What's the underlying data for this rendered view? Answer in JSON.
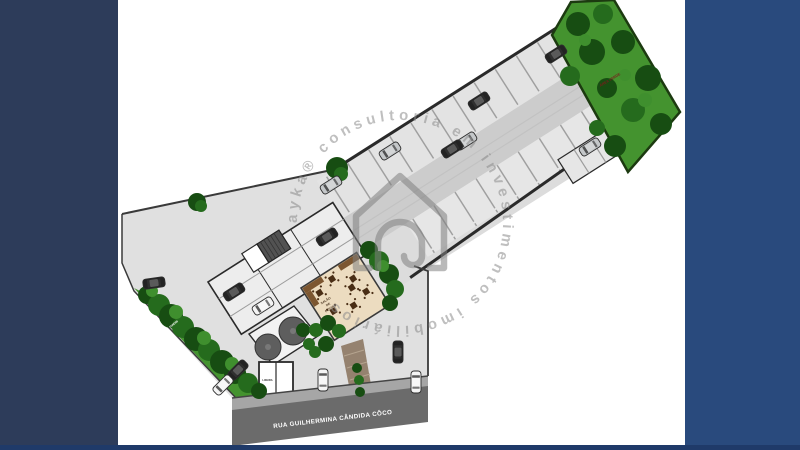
{
  "frame": {
    "background": "#ffffff",
    "left_bar_color": "#2d3c5a",
    "right_bar_color": "#294a7d",
    "bottom_line_color": "#1f3a69"
  },
  "watermark": {
    "circle_text": "ayka®  consultoria em investimentos  imobiliários",
    "color": "#8c8c8c",
    "house_icon": "house-outline-icon"
  },
  "site_plan": {
    "labels": {
      "green_area": "ÁREA VERDE",
      "party_room_line1": "SALÃO",
      "party_room_line2": "DE",
      "party_room_line3": "FESTAS",
      "trash_room": "LIXEIRA",
      "garden": "JARDIM",
      "street": "RUA GUILHERMINA CÂNDIDA CÔCO"
    },
    "colors": {
      "pavement": "#e0e0e0",
      "stall": "#e3e3e3",
      "aisle": "#cccccc",
      "road_dark": "#6b6b6b",
      "road_light": "#a6a6a6",
      "grass": "#44932f",
      "tree_dark": "#174d12",
      "party_room_floor": "#ecdcc0",
      "walkway": "#95826f",
      "boundary": "#333333",
      "green_label": "#7a1c1c"
    },
    "cars": [
      {
        "x": 556,
        "y": 54,
        "angle": -32.5,
        "color": "dark"
      },
      {
        "x": 479,
        "y": 101,
        "angle": -32.5,
        "color": "dark"
      },
      {
        "x": 466,
        "y": 141,
        "angle": -32.5,
        "color": "silver"
      },
      {
        "x": 452,
        "y": 149,
        "angle": -32.5,
        "color": "dark"
      },
      {
        "x": 390,
        "y": 151,
        "angle": -32.5,
        "color": "silver"
      },
      {
        "x": 590,
        "y": 147,
        "angle": -32.5,
        "color": "silver"
      },
      {
        "x": 331,
        "y": 185,
        "angle": -32.5,
        "color": "silver"
      },
      {
        "x": 327,
        "y": 237,
        "angle": -32.5,
        "color": "dark"
      },
      {
        "x": 154,
        "y": 283,
        "angle": -8,
        "color": "dark"
      },
      {
        "x": 234,
        "y": 292,
        "angle": -32.5,
        "color": "dark"
      },
      {
        "x": 263,
        "y": 306,
        "angle": -32.5,
        "color": "white"
      },
      {
        "x": 238,
        "y": 370,
        "angle": -45,
        "color": "dark"
      },
      {
        "x": 223,
        "y": 385,
        "angle": -45,
        "color": "white"
      },
      {
        "x": 398,
        "y": 352,
        "angle": 90,
        "color": "dark"
      },
      {
        "x": 416,
        "y": 382,
        "angle": 90,
        "color": "white"
      },
      {
        "x": 323,
        "y": 380,
        "angle": 90,
        "color": "white"
      }
    ],
    "green_area_trees": [
      {
        "x": 578,
        "y": 24,
        "r": 12,
        "tone": "dark"
      },
      {
        "x": 603,
        "y": 14,
        "r": 10,
        "tone": "mid"
      },
      {
        "x": 592,
        "y": 52,
        "r": 13,
        "tone": "dark"
      },
      {
        "x": 570,
        "y": 76,
        "r": 10,
        "tone": "mid"
      },
      {
        "x": 623,
        "y": 42,
        "r": 12,
        "tone": "dark"
      },
      {
        "x": 648,
        "y": 78,
        "r": 13,
        "tone": "dark"
      },
      {
        "x": 633,
        "y": 110,
        "r": 12,
        "tone": "mid"
      },
      {
        "x": 607,
        "y": 88,
        "r": 10,
        "tone": "dark"
      },
      {
        "x": 661,
        "y": 124,
        "r": 11,
        "tone": "dark"
      },
      {
        "x": 615,
        "y": 146,
        "r": 11,
        "tone": "dark"
      },
      {
        "x": 597,
        "y": 128,
        "r": 8,
        "tone": "mid"
      },
      {
        "x": 645,
        "y": 100,
        "r": 7,
        "tone": "light"
      },
      {
        "x": 585,
        "y": 40,
        "r": 6,
        "tone": "light"
      },
      {
        "x": 625,
        "y": 75,
        "r": 6,
        "tone": "light"
      }
    ],
    "hedge_blobs": [
      {
        "x": 147,
        "y": 295,
        "r": 9,
        "tone": "dark"
      },
      {
        "x": 159,
        "y": 305,
        "r": 11,
        "tone": "mid"
      },
      {
        "x": 171,
        "y": 316,
        "r": 12,
        "tone": "dark"
      },
      {
        "x": 183,
        "y": 327,
        "r": 11,
        "tone": "mid"
      },
      {
        "x": 196,
        "y": 339,
        "r": 12,
        "tone": "dark"
      },
      {
        "x": 209,
        "y": 350,
        "r": 11,
        "tone": "mid"
      },
      {
        "x": 222,
        "y": 362,
        "r": 12,
        "tone": "dark"
      },
      {
        "x": 235,
        "y": 373,
        "r": 11,
        "tone": "dark"
      },
      {
        "x": 248,
        "y": 383,
        "r": 10,
        "tone": "mid"
      },
      {
        "x": 259,
        "y": 391,
        "r": 8,
        "tone": "dark"
      },
      {
        "x": 152,
        "y": 291,
        "r": 6,
        "tone": "light"
      },
      {
        "x": 176,
        "y": 312,
        "r": 7,
        "tone": "light"
      },
      {
        "x": 204,
        "y": 338,
        "r": 7,
        "tone": "light"
      },
      {
        "x": 232,
        "y": 364,
        "r": 7,
        "tone": "light"
      }
    ],
    "misc_blobs": [
      {
        "x": 369,
        "y": 250,
        "r": 9,
        "tone": "dark"
      },
      {
        "x": 379,
        "y": 261,
        "r": 10,
        "tone": "mid"
      },
      {
        "x": 389,
        "y": 274,
        "r": 10,
        "tone": "dark"
      },
      {
        "x": 395,
        "y": 289,
        "r": 9,
        "tone": "mid"
      },
      {
        "x": 390,
        "y": 303,
        "r": 8,
        "tone": "dark"
      },
      {
        "x": 383,
        "y": 266,
        "r": 6,
        "tone": "light"
      },
      {
        "x": 303,
        "y": 330,
        "r": 7,
        "tone": "dark"
      },
      {
        "x": 309,
        "y": 344,
        "r": 6,
        "tone": "mid"
      },
      {
        "x": 357,
        "y": 368,
        "r": 5,
        "tone": "dark"
      },
      {
        "x": 359,
        "y": 380,
        "r": 5,
        "tone": "mid"
      },
      {
        "x": 360,
        "y": 392,
        "r": 5,
        "tone": "dark"
      },
      {
        "x": 316,
        "y": 330,
        "r": 7,
        "tone": "mid"
      },
      {
        "x": 328,
        "y": 323,
        "r": 8,
        "tone": "dark"
      },
      {
        "x": 339,
        "y": 331,
        "r": 7,
        "tone": "mid"
      },
      {
        "x": 326,
        "y": 344,
        "r": 8,
        "tone": "dark"
      },
      {
        "x": 315,
        "y": 352,
        "r": 6,
        "tone": "mid"
      },
      {
        "x": 337,
        "y": 168,
        "r": 11,
        "tone": "dark"
      },
      {
        "x": 341,
        "y": 174,
        "r": 7,
        "tone": "mid"
      },
      {
        "x": 197,
        "y": 202,
        "r": 9,
        "tone": "dark"
      },
      {
        "x": 201,
        "y": 206,
        "r": 6,
        "tone": "mid"
      }
    ]
  }
}
